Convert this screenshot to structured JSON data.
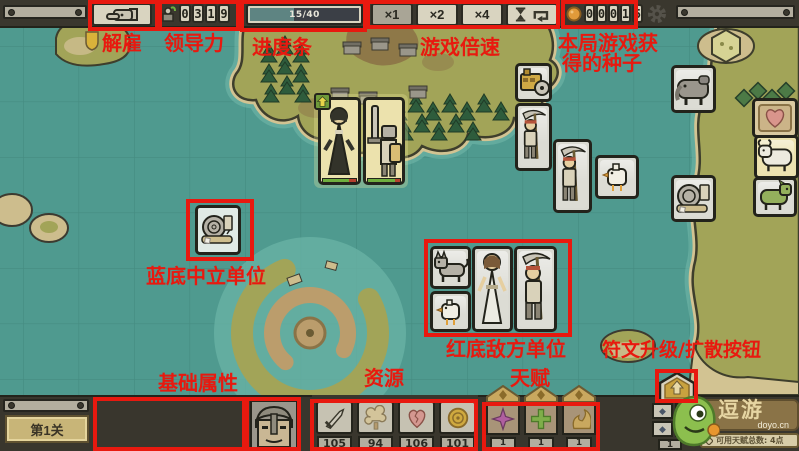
{
  "annotations": {
    "dismiss": "解雇",
    "leadership": "领导力",
    "progress": "进度条",
    "speed": "游戏倍速",
    "seeds_line1": "本局游戏获",
    "seeds_line2": "得的种子",
    "neutral": "蓝底中立单位",
    "enemy": "红底敌方单位",
    "attrs": "基础属性",
    "resources": "资源",
    "talents": "天赋",
    "rune": "符文升级/扩散按钮",
    "color": "#e8190f"
  },
  "topbar": {
    "leadership_digits": [
      "0",
      "3",
      "1",
      "9"
    ],
    "seed_digits": [
      "0",
      "0",
      "0",
      "1",
      "5"
    ],
    "progress": {
      "label": "15/40",
      "percent": 40
    },
    "speed": {
      "x1": "×1",
      "x2": "×2",
      "x4": "×4"
    }
  },
  "stage_label": "第1关",
  "unit_info": {
    "race": "人形",
    "alignment": "正直",
    "name": "皇家剑士",
    "stars": "◆◆◆◆",
    "level": "Lv. 2",
    "hp_label": "HP.",
    "hp_value": "114/128",
    "exp_label": "EXP.",
    "exp_value": "37/2000",
    "atk_label": "ATK.",
    "atk": "18",
    "spd_label": "SPD.",
    "spd": "150",
    "def_label": "DEF.",
    "def": "14",
    "luk_label": "LUK.",
    "luk": "16"
  },
  "resources": {
    "items": [
      {
        "name": "sword-icon",
        "value": "105"
      },
      {
        "name": "plant-icon",
        "value": "94"
      },
      {
        "name": "heart-icon",
        "value": "106"
      },
      {
        "name": "coin-icon",
        "value": "101"
      }
    ]
  },
  "talents": {
    "counts": [
      "1",
      "1",
      "1"
    ]
  },
  "rune_panel": {
    "count": "1",
    "cell_glyph": "◆"
  },
  "watermark": {
    "brand": "逗游",
    "site": "doyo.cn",
    "note": "可用天赋总数: 4点"
  }
}
